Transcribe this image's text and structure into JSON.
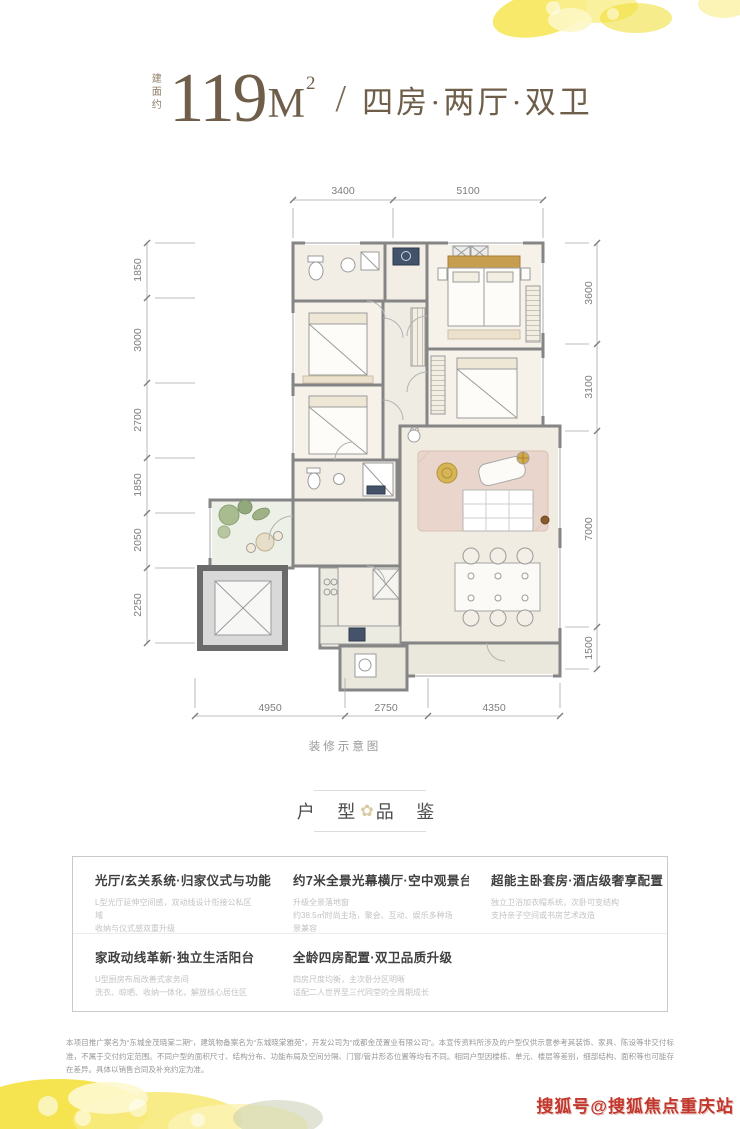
{
  "header": {
    "area_prefix": "建面约",
    "area_value": "119",
    "area_unit": "M",
    "area_sup": "2",
    "divider": "/",
    "layout_text": "四房·两厅·双卫"
  },
  "floor_plan": {
    "caption": "装修示意图",
    "dimensions": {
      "top": [
        "3400",
        "5100"
      ],
      "left": [
        "1850",
        "3000",
        "2700",
        "1850",
        "2050",
        "2250"
      ],
      "right": [
        "3600",
        "3100",
        "7000",
        "1500"
      ],
      "bottom": [
        "4950",
        "2750",
        "4350"
      ]
    }
  },
  "section_header": {
    "left": "户 型",
    "right": "品 鉴",
    "flower": "✿"
  },
  "features": [
    {
      "title": "光厅/玄关系统·归家仪式与功能并存",
      "desc1": "L型光厅延伸空间感，双动线设计衔接公私区域",
      "desc2": "收纳与仪式感双重升级"
    },
    {
      "title": "约7米全景光幕横厅·空中观景台",
      "desc1": "升级全景落地窗",
      "desc2": "约38.5㎡时尚主场，聚会、互动、娱乐多种场景兼容"
    },
    {
      "title": "超能主卧套房·酒店级奢享配置",
      "desc1": "独立卫浴加衣帽系统，次卧可变结构",
      "desc2": "支持亲子空间或书房艺术改造"
    },
    {
      "title": "家政动线革新·独立生活阳台",
      "desc1": "U型厨房布局改善式家务间",
      "desc2": "洗衣、晾晒、收纳一体化，解放核心居住区"
    },
    {
      "title": "全龄四房配置·双卫品质升级",
      "desc1": "四房尺度均衡，主次卧分区明晰",
      "desc2": "适配二人世界至三代同堂的全周期成长"
    }
  ],
  "disclaimer": "本项目推广案名为“东城金茂晓棠二期”，建筑物备案名为“东城晓棠雅苑”，开发公司为“成都金茂置业有限公司”。本宣传资料所涉及的户型仅供示意参考其装饰、家具、陈设等非交付标准，不属于交付约定范围。不同户型的面积尺寸、结构分布、功能布局及空间分隔、门窗/管井形态位置等均有不同。相同户型因楼栋、单元、楼层等差别，细部结构、面积等也可能存在差异。具体以销售合同及补充约定为准。",
  "watermark": "搜狐号@搜狐焦点重庆站",
  "colors": {
    "title_brown": "#6f5f4a",
    "wall_gray": "#858585",
    "gold": "#c79e4f",
    "watermark_red": "#c2362b",
    "decor_yellow": "#f3e044"
  }
}
